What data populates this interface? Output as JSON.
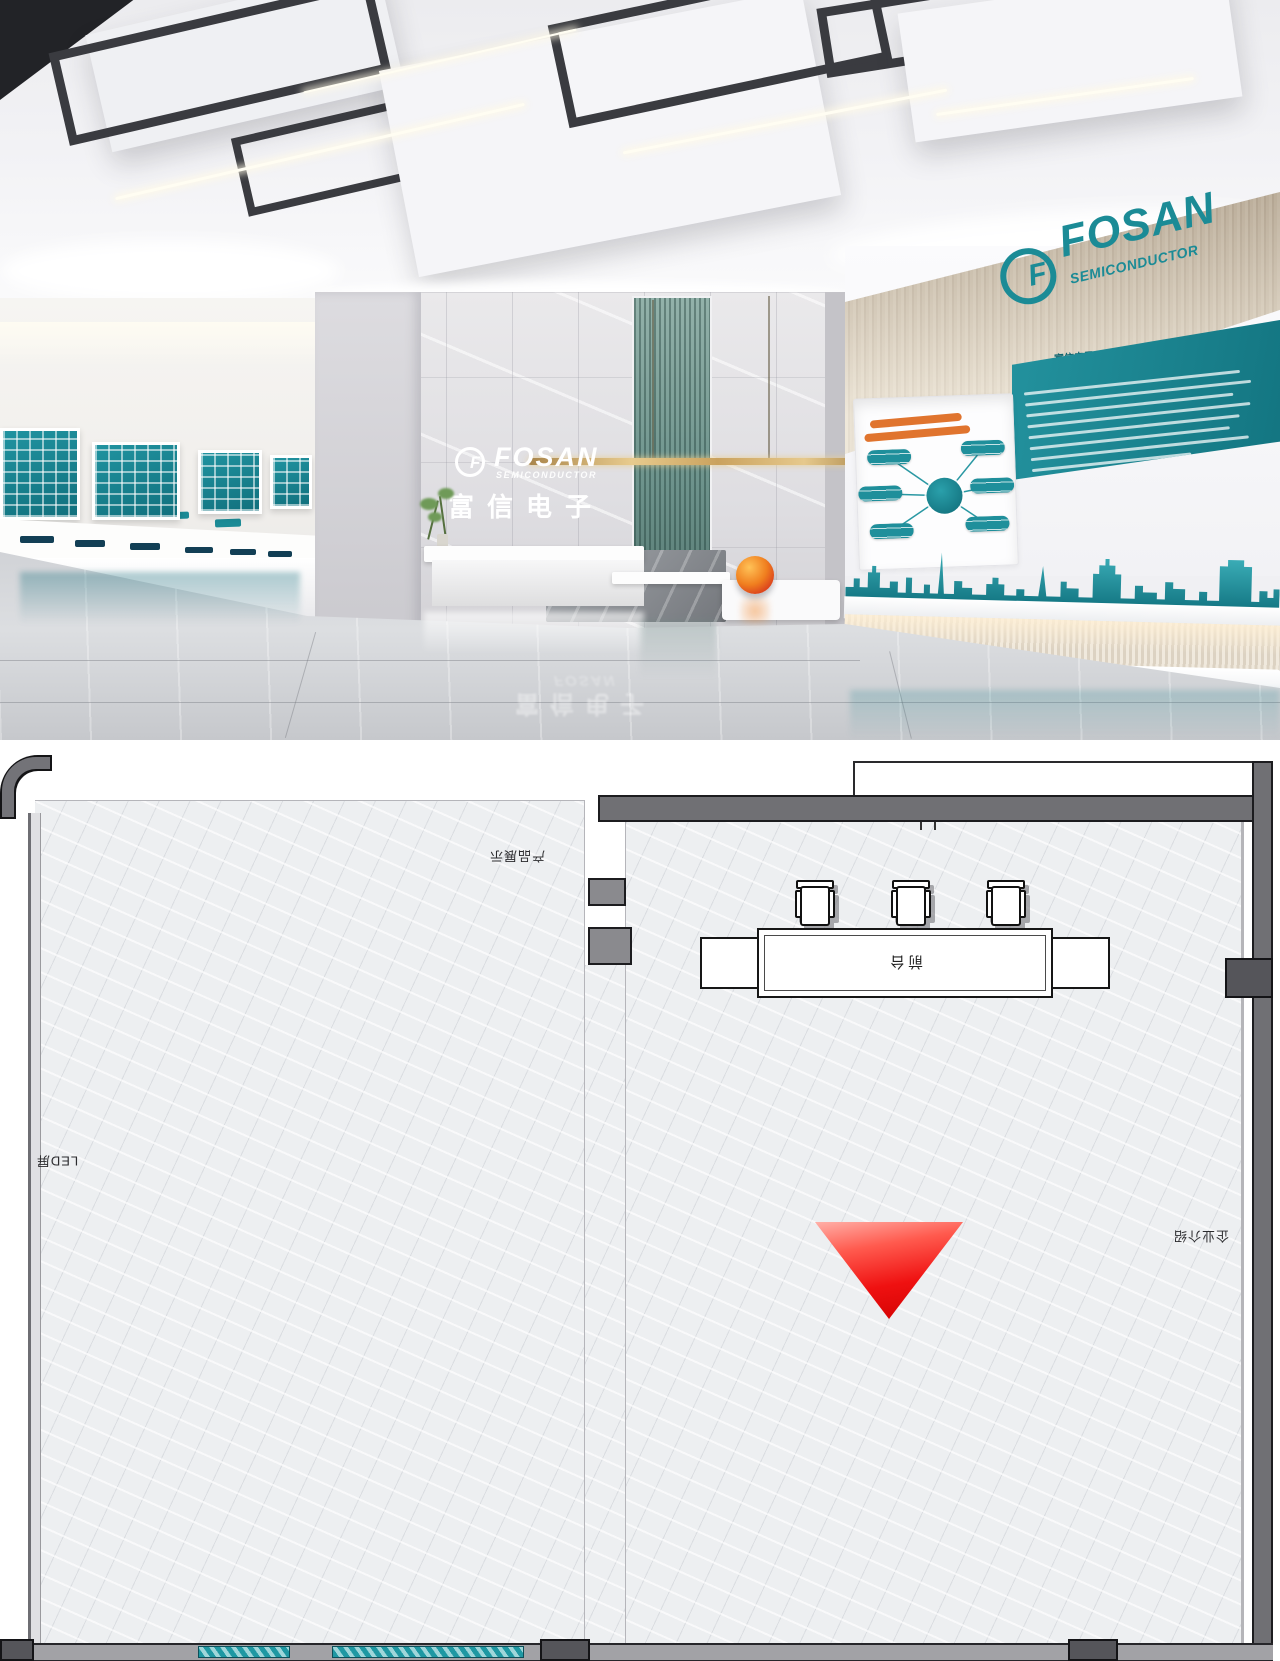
{
  "photo": {
    "brand": {
      "icon_letter": "F",
      "name": "FOSAN",
      "subtitle": "SEMICONDUCTOR",
      "cn_name": "富信电子"
    },
    "right_wall": {
      "heading": "富信电子  FOSAN"
    }
  },
  "floor_plan": {
    "labels": {
      "reception_desk": "前台",
      "led_screen": "LED屏",
      "company_intro": "企业介绍",
      "product_display": "产品展示"
    },
    "chair_count": 3,
    "marker": {
      "shape": "down-triangle",
      "color": "#e60000"
    }
  },
  "colors": {
    "teal": "#1b8b96",
    "orange": "#e0742e",
    "wood": "#cfc3b1",
    "marker_red": "#e60000"
  }
}
